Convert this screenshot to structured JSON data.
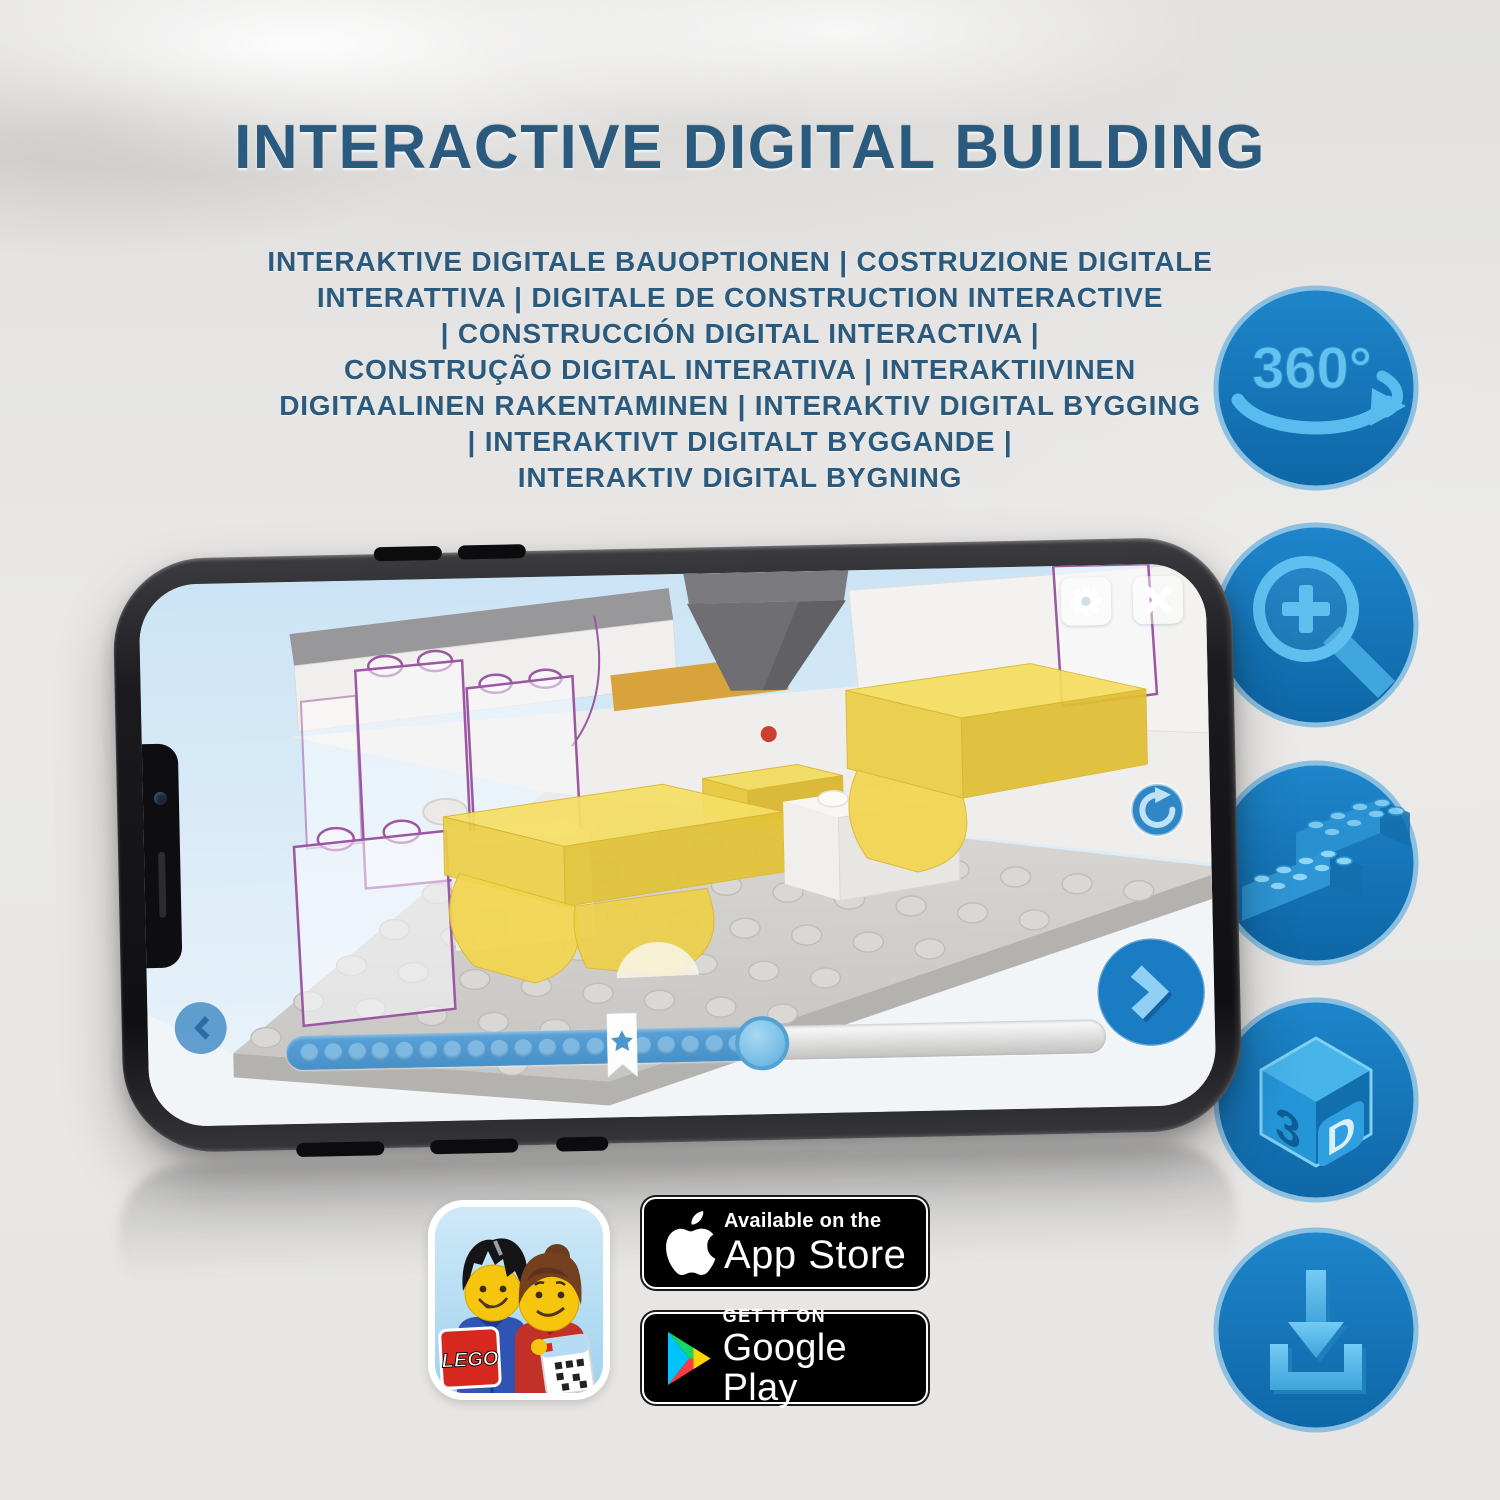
{
  "header": {
    "title": "INTERACTIVE DIGITAL BUILDING"
  },
  "subtitle": {
    "lines": [
      "INTERAKTIVE DIGITALE BAUOPTIONEN | COSTRUZIONE DIGITALE",
      "INTERATTIVA | DIGITALE DE CONSTRUCTION INTERACTIVE",
      "| CONSTRUCCIÓN DIGITAL INTERACTIVA |",
      "CONSTRUÇÃO DIGITAL INTERATIVA | INTERAKTIIVINEN",
      "DIGITAALINEN RAKENTAMINEN | INTERAKTIV DIGITAL BYGGING",
      "| INTERAKTIVT DIGITALT BYGGANDE |",
      "INTERAKTIV DIGITAL BYGNING"
    ]
  },
  "features": {
    "rotate360": {
      "icon": "360-rotation-icon",
      "label": "360°"
    },
    "zoom": {
      "icon": "magnifier-plus-icon"
    },
    "brick": {
      "icon": "lego-brick-icon"
    },
    "threeD": {
      "icon": "3d-cube-icon",
      "digit": "3",
      "letter": "D"
    },
    "download": {
      "icon": "download-tray-icon"
    }
  },
  "phone": {
    "screen": {
      "toolbar": {
        "settings_icon": "gear-icon",
        "close_icon": "close-x-icon"
      },
      "rotate_icon": "rotate-clockwise-icon",
      "nav": {
        "back_icon": "chevron-left-icon",
        "next_icon": "chevron-right-icon"
      },
      "slider": {
        "progress_percent": 58,
        "bookmark_percent": 41,
        "star_icon": "star-bookmark-icon",
        "dot_count": 19
      }
    }
  },
  "badges": {
    "app_store": {
      "icon": "apple-logo-icon",
      "tagline": "Available on the",
      "store_name": "App Store"
    },
    "google_play": {
      "icon": "google-play-triangle-icon",
      "tagline": "GET IT ON",
      "store_name": "Google Play"
    },
    "lego_app": {
      "icon": "lego-app-icon",
      "logo_text": "LEGO"
    }
  },
  "colors": {
    "title_blue": "#2a5a7e",
    "circle_blue": "#1577bd",
    "glyph_light_blue": "#5fc0ef",
    "screen_sky": "#d9ecf8",
    "brick_yellow": "#f3d84f",
    "badge_black": "#000000",
    "lego_red": "#d6281e"
  }
}
